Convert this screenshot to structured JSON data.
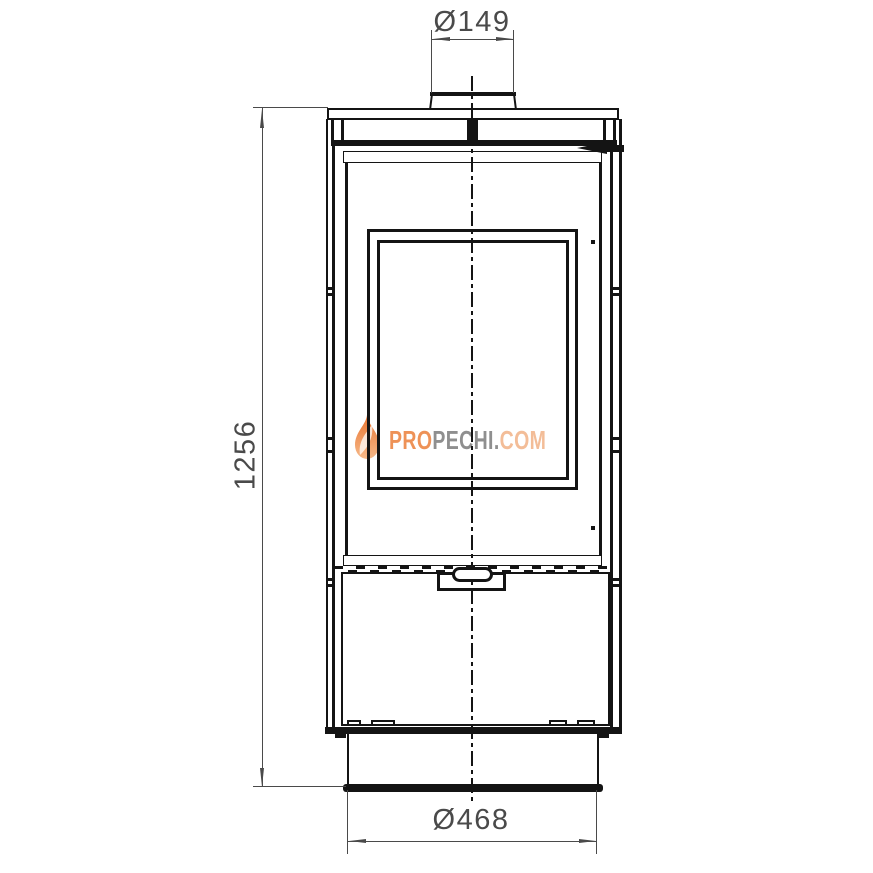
{
  "drawing": {
    "dimensions": {
      "flue": {
        "label": "Ø149"
      },
      "height": {
        "label": "1256"
      },
      "base": {
        "label": "Ø468"
      }
    },
    "watermark": {
      "segment_pro": "PRO",
      "segment_pechi": "PECHI",
      "segment_dot": ".",
      "segment_com": "COM"
    },
    "colors": {
      "line": "#141414",
      "dimension": "#4a4a4a",
      "watermark_orange": "#ee9257",
      "watermark_gray": "#8f8f8f",
      "watermark_light_orange": "#f3bd98",
      "flame_top": "#e9742f",
      "flame_bottom": "#f6b98a",
      "background": "#ffffff"
    }
  }
}
